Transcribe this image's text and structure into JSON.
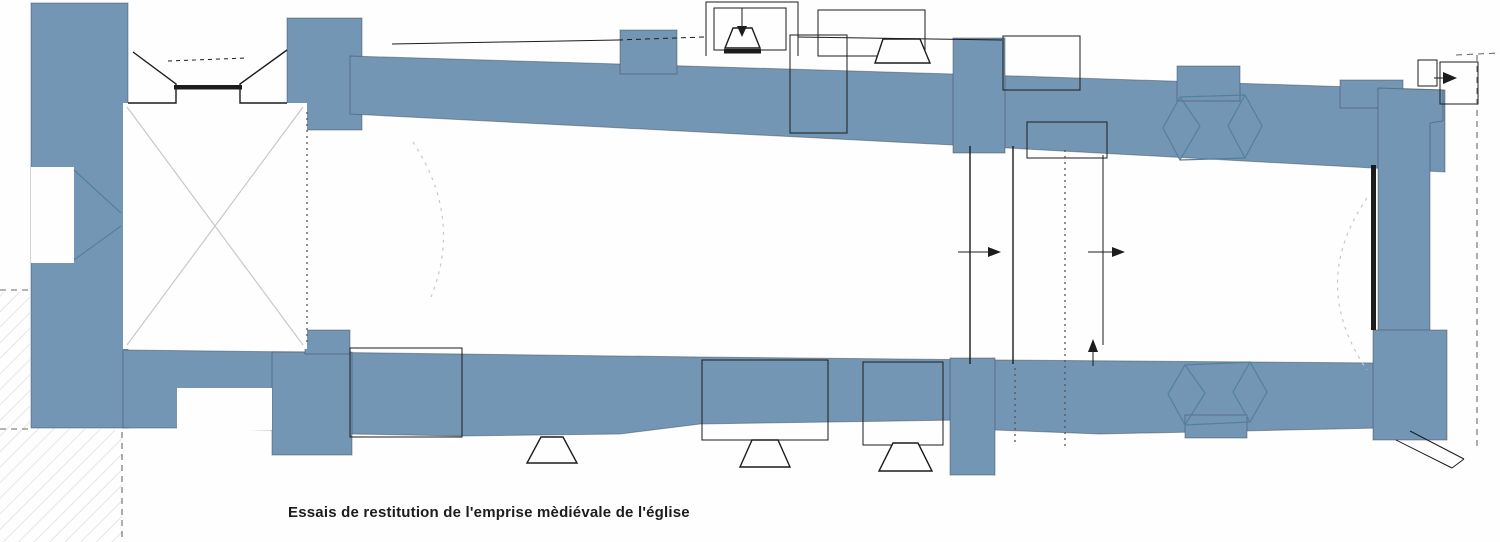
{
  "figure": {
    "caption": "Essais de restitution de l'emprise mèdiévale de l'église"
  },
  "palette": {
    "paper": "#fefefe",
    "wall-blue": "#7396b5",
    "wall-blue-dark": "#53809f",
    "edge": "#39404d",
    "line-black": "#1c1c1c",
    "faint-gray": "#c8c8c8",
    "hatch-gray": "#d9ddd9"
  }
}
